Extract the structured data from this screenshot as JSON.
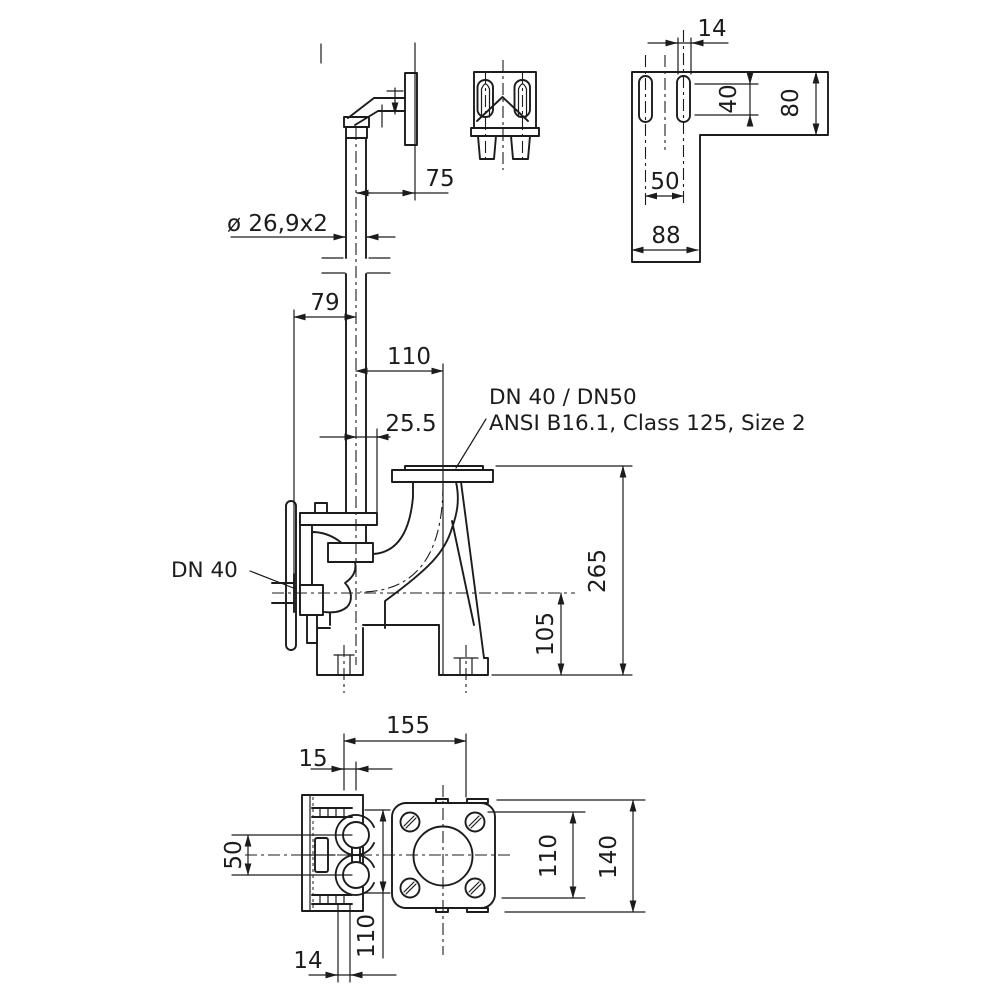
{
  "views": {
    "side": {
      "labels": {
        "flange_line1": "DN 40 / DN50",
        "flange_line2": "ANSI B16.1, Class 125, Size 2",
        "inlet": "DN 40",
        "pipe": "ø 26,9x2"
      },
      "dims": {
        "bracket_to_wall": "75",
        "inlet_to_pipe": "79",
        "pipe_to_flange": "110",
        "offset": "25.5",
        "total_height": "265",
        "inlet_height": "105"
      }
    },
    "wall_bracket": {
      "dims": {
        "slot_width": "14",
        "slot_length": "40",
        "height": "80",
        "slot_spacing": "50",
        "width": "88"
      }
    },
    "plan": {
      "dims": {
        "foot_spacing": "155",
        "foot_offset": "15",
        "port_spacing": "50",
        "body_width": "110",
        "flange_width": "140",
        "hole_spacing": "110",
        "slot_width": "14"
      }
    }
  }
}
